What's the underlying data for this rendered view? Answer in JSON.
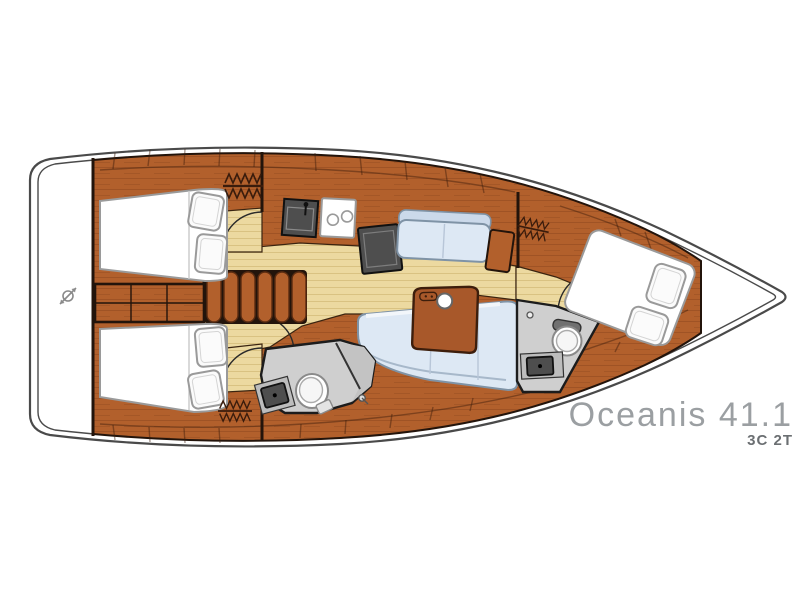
{
  "title": {
    "name": "Oceanis 41.1",
    "variant_code": "3C 2T"
  },
  "colors": {
    "hull": "#4a4a4a",
    "wood": "#b2602c",
    "wood_dark": "#7a3c16",
    "outline": "#23140b",
    "floor": "#ecd9a0",
    "floor_line": "#d9c282",
    "berth": "#ffffff",
    "berth_stroke": "#9a9a9a",
    "upholstery": "#dde8f4",
    "upholstery_stroke": "#7f93a6",
    "wet": "#cfcfcf",
    "appliance": "#4e4e4e",
    "title": "#9b9fa2",
    "subtitle": "#6b6f72"
  },
  "icons": {
    "helm": "helm-icon",
    "hanging_locker": "hanging-locker-icon",
    "stove_burners": "stove-burner-icon",
    "faucet": "faucet-icon"
  }
}
